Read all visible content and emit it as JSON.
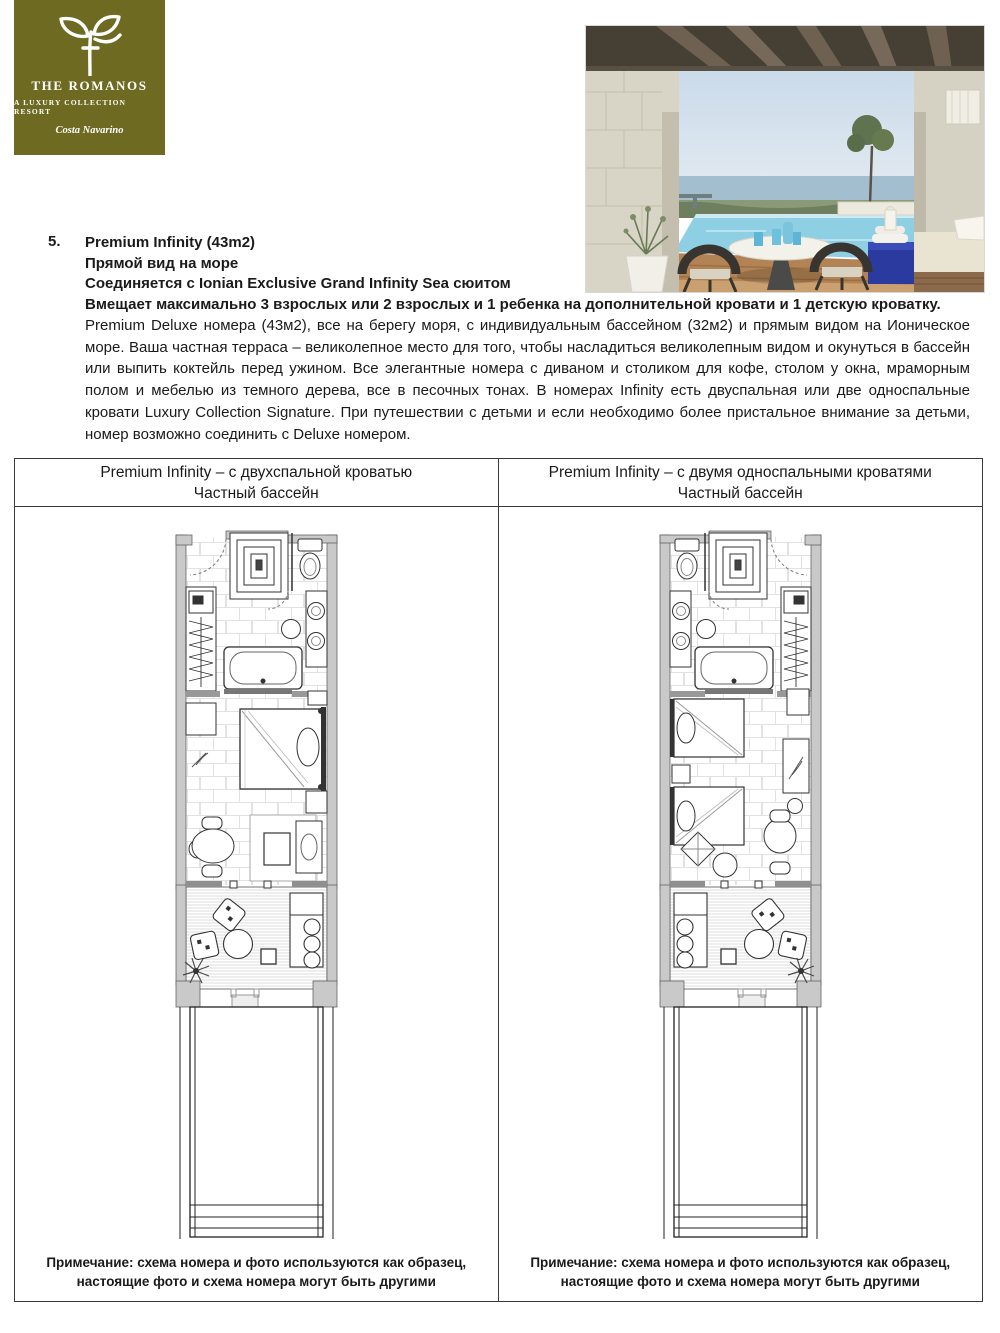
{
  "logo": {
    "title": "THE ROMANOS",
    "subtitle": "A LUXURY COLLECTION RESORT",
    "location": "Costa Navarino",
    "icon": "olive-branch-icon",
    "bg_color": "#6e6a22"
  },
  "photo": {
    "description": "terrace with private infinity pool, round table, two chairs and sea view"
  },
  "section": {
    "number": "5.",
    "heading_lines": [
      "Premium Infinity (43m2)",
      "Прямой вид на море",
      "Соединяется с Ionian Exclusive Grand Infinity Sea сюитом",
      "Вмещает максимально 3 взрослых или 2 взрослых и 1 ребенка на дополнительной кровати и 1 детскую кроватку."
    ],
    "paragraph": "Premium Deluxe номера (43м2), все на берегу моря, с индивидуальным бассейном (32м2) и прямым видом на Ионическое море. Ваша частная терраса – великолепное место для того, чтобы насладиться великолепным видом и окунуться в бассейн или выпить коктейль перед ужином. Все элегантные номера с диваном и столиком для кофе, столом у окна, мраморным полом и мебелью из темного дерева, все в песочных тонах. В номерах Infinity есть двуспальная или две односпальные кровати  Luxury Collection Signature. При путешествии с детьми и если необходимо более пристальное внимание за детьми, номер возможно соединить с Deluxe номером."
  },
  "table": {
    "columns": [
      {
        "header_line1": "Premium Infinity – с двухспальной кроватью",
        "header_line2": "Частный бассейн",
        "plan": "floor-plan-double-bed",
        "note_line1": "Примечание: схема номера и фото используются как образец,",
        "note_line2": "настоящие фото и схема номера могут быть другими"
      },
      {
        "header_line1": "Premium Infinity – с двумя односпальными кроватями",
        "header_line2": "Частный бассейн",
        "plan": "floor-plan-twin-beds",
        "note_line1": "Примечание: схема номера и фото используются как образец,",
        "note_line2": "настоящие фото и схема номера могут быть другими"
      }
    ]
  },
  "colors": {
    "brand_olive": "#6e6a22",
    "table_border": "#3a3a3a",
    "plan_wall_gray": "#c9c9c9",
    "pool_blue": "#8ecfe4",
    "deck_wood": "#b28354"
  }
}
